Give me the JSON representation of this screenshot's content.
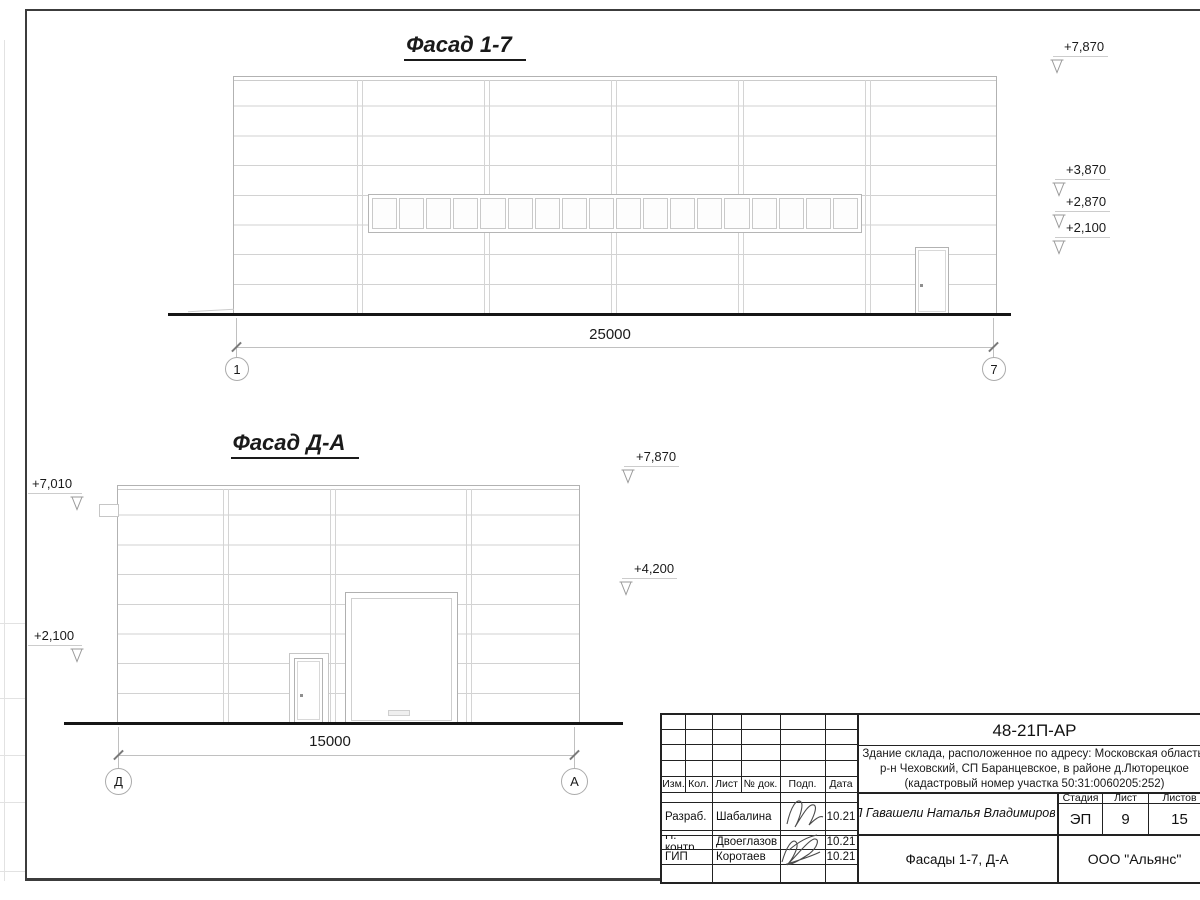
{
  "ink_color": "#1a1a1a",
  "facade1": {
    "title": "Фасад 1-7",
    "dimension": "25000",
    "axis_left": "1",
    "axis_right": "7",
    "elevations": [
      {
        "label": "+7,870"
      },
      {
        "label": "+3,870"
      },
      {
        "label": "+2,870"
      },
      {
        "label": "+2,100"
      }
    ]
  },
  "facade2": {
    "title": "Фасад Д-А",
    "dimension": "15000",
    "axis_left": "Д",
    "axis_right": "А",
    "elevations_left": [
      {
        "label": "+7,010"
      },
      {
        "label": "+2,100"
      }
    ],
    "elevations_right": [
      {
        "label": "+7,870"
      },
      {
        "label": "+4,200"
      }
    ]
  },
  "title_block": {
    "doc_number": "48-21П-АР",
    "address_line1": "Здание склада, расположенное по адресу: Московская область,",
    "address_line2": "р-н Чеховский, СП Баранцевское, в районе д.Люторецкое",
    "address_line3": "(кадастровый номер участка 50:31:0060205:252)",
    "header_cols": [
      "Изм.",
      "Кол.",
      "Лист",
      "№ док.",
      "Подп.",
      "Дата"
    ],
    "rows": [
      {
        "role": "Разраб.",
        "name": "Шабалина",
        "date": "10.21"
      },
      {
        "role": "Н. контр.",
        "name": "Двоеглазов",
        "date": "10.21"
      },
      {
        "role": "ГИП",
        "name": "Коротаев",
        "date": "10.21"
      }
    ],
    "client": "ИП Гавашели Наталья Владимировна",
    "stage_label": "Стадия",
    "sheet_label": "Лист",
    "sheets_label": "Листов",
    "stage": "ЭП",
    "sheet_no": "9",
    "sheets_total": "15",
    "drawing_title": "Фасады 1-7, Д-А",
    "company": "ООО \"Альянс\""
  }
}
